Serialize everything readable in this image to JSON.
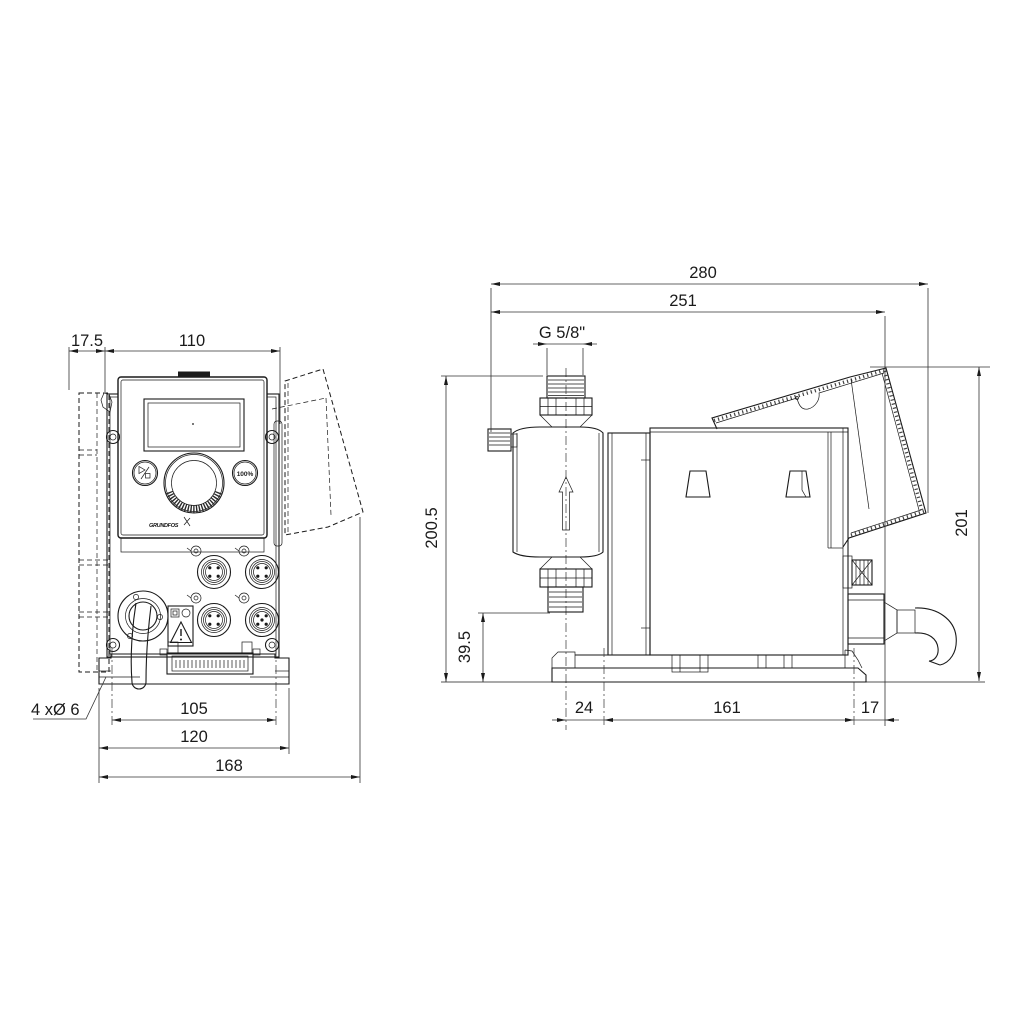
{
  "front": {
    "dims": {
      "plate_depth": "17.5",
      "body_width": "110",
      "hole_pitch": "105",
      "plate_width": "120",
      "overall_width": "168",
      "mounting_holes": "4 xØ 6"
    },
    "panel": {
      "percent_button": "100%",
      "brand": "GRUNDFOS"
    }
  },
  "side": {
    "dims": {
      "overall_length": "280",
      "length_to_module": "251",
      "thread": "G 5/8\"",
      "height_to_port": "200.5",
      "valve_height": "39.5",
      "head_offset": "24",
      "hole_pitch": "161",
      "edge_offset": "17",
      "overall_height": "201"
    }
  }
}
